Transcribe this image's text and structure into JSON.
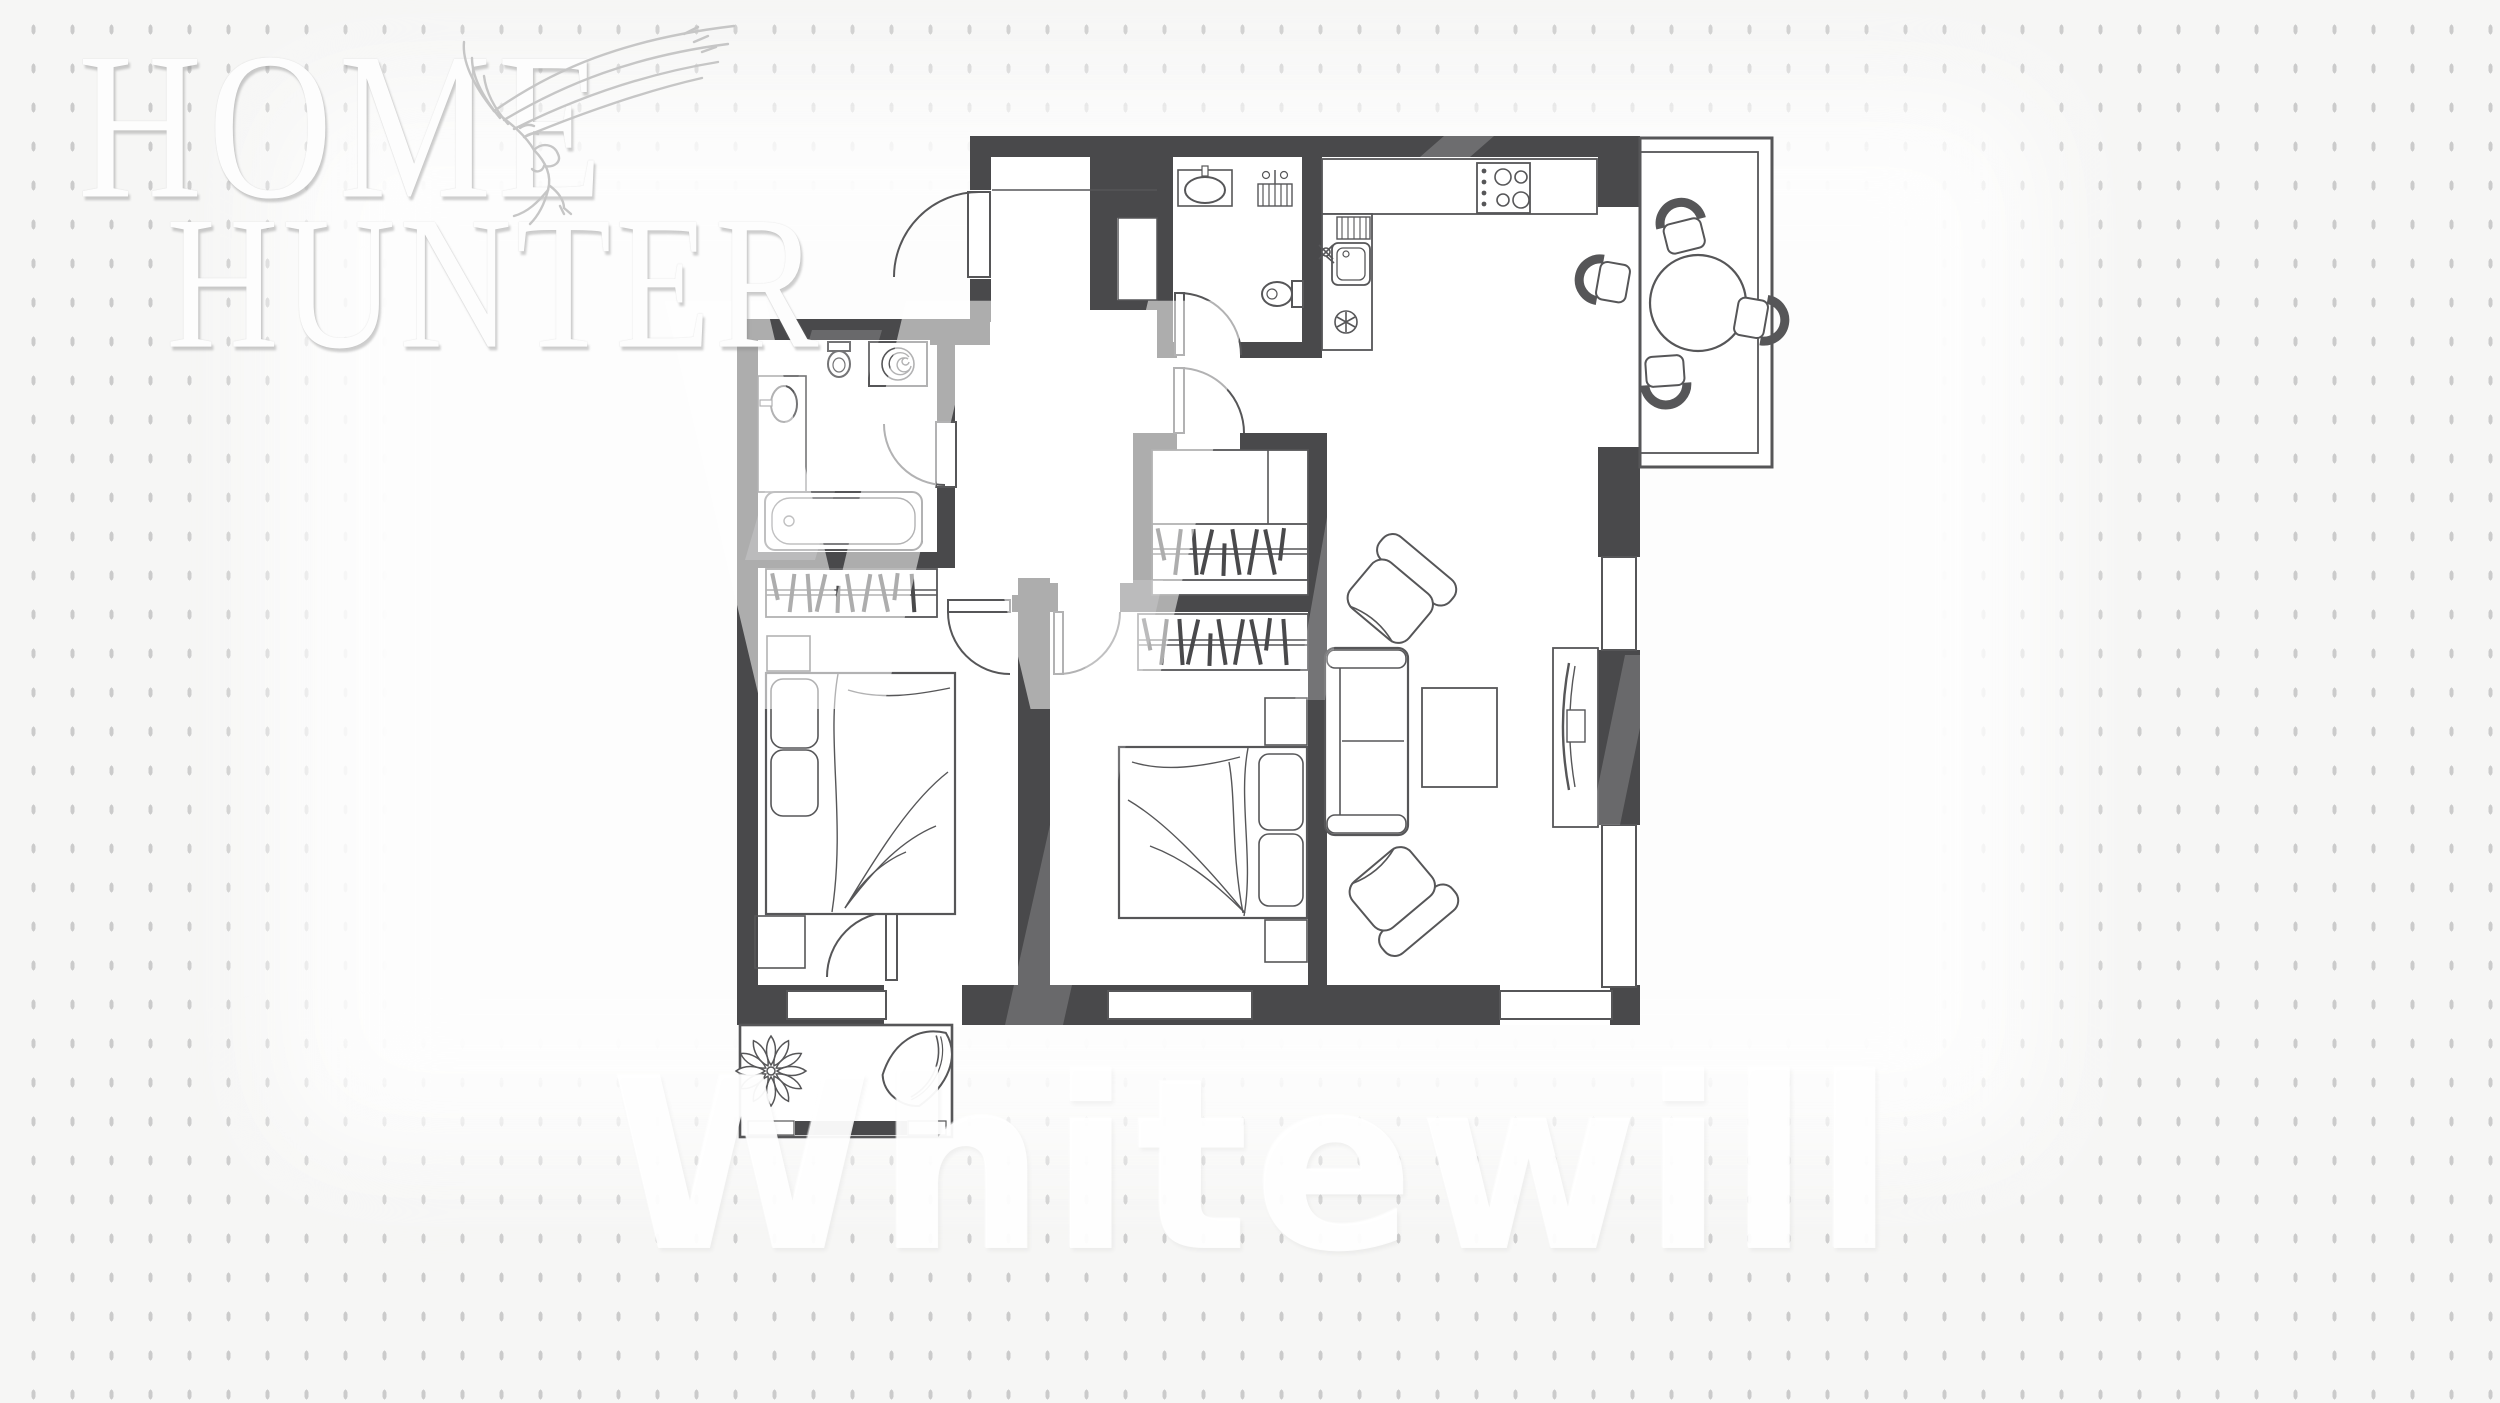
{
  "logo": {
    "line1": "HOME",
    "line2": "HUNTER",
    "icon": "eagle-icon"
  },
  "watermarks": {
    "big_letter": "W",
    "bottom_text": "Whitewill"
  },
  "colors": {
    "background": "#f6f6f5",
    "dots": "#cbcbcb",
    "wall": "#49494b",
    "line": "#565658",
    "floor": "#ffffff"
  },
  "floorplan": {
    "type": "apartment-floor-plan",
    "rooms": [
      {
        "name": "entry-hall",
        "features": [
          "entry-door",
          "duct-niche"
        ]
      },
      {
        "name": "bathroom-1",
        "features": [
          "toilet",
          "washing-machine",
          "sink-counter",
          "bathtub",
          "door"
        ]
      },
      {
        "name": "bathroom-2",
        "features": [
          "sink",
          "towel-rack",
          "toilet",
          "door"
        ]
      },
      {
        "name": "kitchen",
        "features": [
          "counter",
          "stove-4-burners",
          "kitchen-sink",
          "dish-rack",
          "vent-fan"
        ]
      },
      {
        "name": "dining-balcony",
        "features": [
          "round-table",
          "chair",
          "chair",
          "chair",
          "chair"
        ]
      },
      {
        "name": "walk-in-closet",
        "features": [
          "shelf-divider",
          "hanger-rod",
          "door"
        ]
      },
      {
        "name": "bedroom-1",
        "features": [
          "wardrobe-hangers",
          "double-bed",
          "pillow",
          "pillow",
          "nightstand",
          "nightstand",
          "window",
          "balcony-door",
          "door"
        ]
      },
      {
        "name": "bedroom-2",
        "features": [
          "wardrobe-hangers",
          "double-bed",
          "pillow",
          "pillow",
          "nightstand",
          "nightstand",
          "window",
          "door"
        ]
      },
      {
        "name": "living-room",
        "features": [
          "sofa",
          "coffee-table",
          "armchair",
          "armchair",
          "tv-stand",
          "window",
          "corner-window"
        ]
      },
      {
        "name": "balcony",
        "features": [
          "plant",
          "lounge-chair"
        ]
      }
    ]
  }
}
